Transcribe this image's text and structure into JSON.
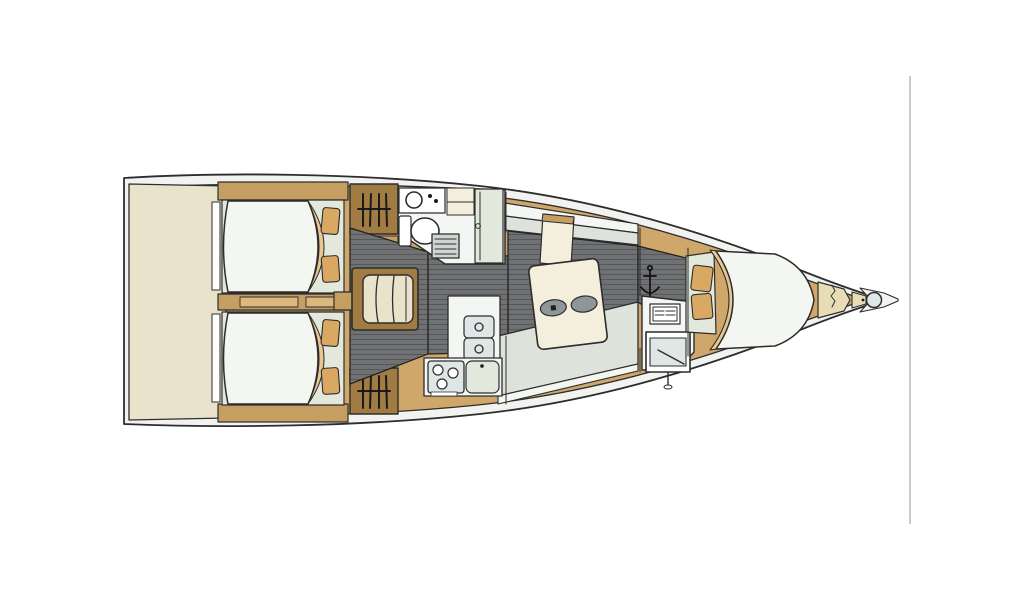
{
  "meta": {
    "title": "Sailing yacht interior floor plan (top view, bow pointing right)",
    "canvas": {
      "width": 1024,
      "height": 600
    },
    "diagram_type": "boat-deck-layout",
    "background": "#ffffff"
  },
  "palette": {
    "line": "#2d2d2d",
    "hull_band": "#f2f3f0",
    "wood": "#cfa76b",
    "wood_dark": "#a07b42",
    "wood_mid": "#c59f62",
    "wood_light": "#dcb87e",
    "cream": "#eae3cc",
    "white_room": "#f4f6f3",
    "bed_white": "#f3f6f1",
    "pale_green": "#e2e8dc",
    "pillow": "#d9a963",
    "blanket": "#e9c795",
    "floor": "#6f7173",
    "floor_line": "#55575a",
    "settee": "#dde3da",
    "table": "#f4eedd",
    "oval": "#8d9798",
    "grate": "#cfd6d2",
    "steel": "#dfe7e6",
    "locker": "#e7dcb6",
    "artifact": "#9a9a9a"
  },
  "regions": [
    {
      "name": "stern-platform",
      "features": [
        "transom",
        "swim-platform"
      ]
    },
    {
      "name": "aft-cabin-port",
      "features": [
        "double-berth",
        "pillows",
        "hanging-locker"
      ]
    },
    {
      "name": "aft-cabin-starboard",
      "features": [
        "double-berth",
        "pillows",
        "hanging-locker"
      ]
    },
    {
      "name": "companionway",
      "features": [
        "steps"
      ]
    },
    {
      "name": "aft-head",
      "features": [
        "toilet",
        "washbasin",
        "shower-grate",
        "cabinets"
      ]
    },
    {
      "name": "salon",
      "features": [
        "settee-port",
        "settee-starboard",
        "table",
        "cup-recesses"
      ]
    },
    {
      "name": "galley",
      "features": [
        "three-burner-stove",
        "double-sink",
        "counter"
      ]
    },
    {
      "name": "nav-station",
      "features": [
        "chart-table",
        "vent-grille"
      ]
    },
    {
      "name": "forward-cabin",
      "features": [
        "v-berth",
        "pillows",
        "blanket"
      ]
    },
    {
      "name": "bow",
      "features": [
        "anchor-locker",
        "windlass",
        "bowsprit"
      ]
    }
  ],
  "icons": [
    "hanger-icon",
    "anchor-icon",
    "toilet-icon",
    "washbasin-icon",
    "stove-burners-icon",
    "vent-grille-icon",
    "windlass-icon",
    "shower-grate-icon"
  ],
  "artifact_line": {
    "x1": 910,
    "y1": 76,
    "x2": 910,
    "y2": 524,
    "color": "#9a9a9a",
    "width": 1
  }
}
